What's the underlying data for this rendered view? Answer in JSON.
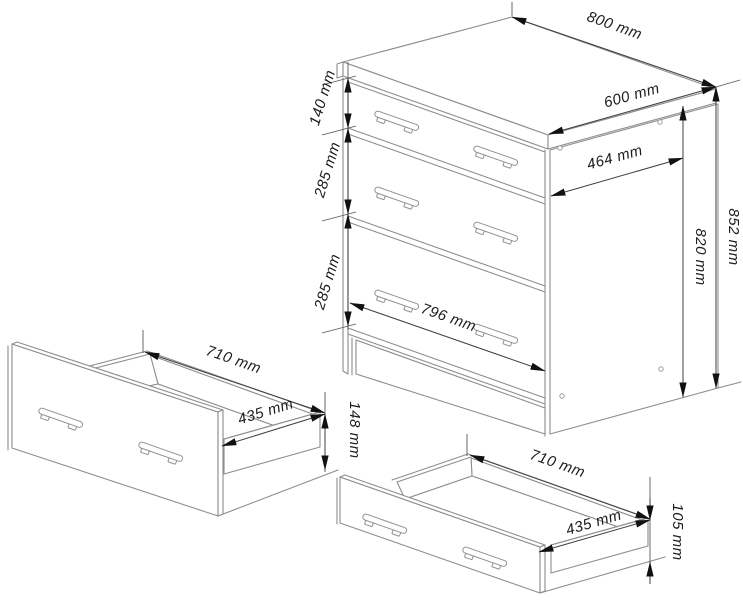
{
  "drawing": {
    "cabinet": {
      "top_width": "800 mm",
      "top_depth": "600 mm",
      "inner_depth": "464 mm",
      "height_total": "852 mm",
      "height_carcass": "820 mm",
      "drawer1_height": "140 mm",
      "drawer2_height": "285 mm",
      "drawer3_height": "285 mm",
      "front_width": "796 mm"
    },
    "drawer_left": {
      "width": "710 mm",
      "depth": "435 mm",
      "front_height": "148 mm"
    },
    "drawer_right": {
      "width": "710 mm",
      "depth": "435 mm",
      "front_height": "105 mm"
    }
  },
  "colors": {
    "background": "#ffffff",
    "object_line": "#8d8d8d",
    "dimension_line": "#3f3f3f",
    "arrow": "#111111",
    "text": "#1c1c1c"
  }
}
